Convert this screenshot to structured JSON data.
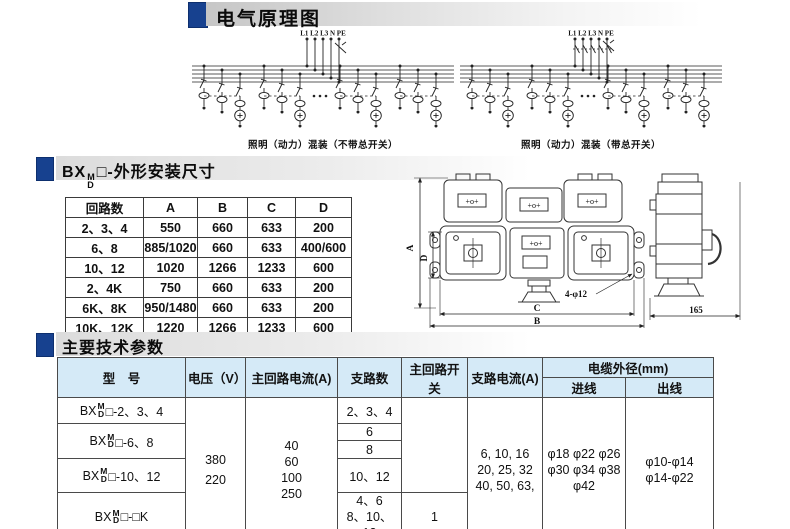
{
  "page": {
    "accent_blue": "#17418f",
    "spec_header_bg": "#d5eaf7"
  },
  "schematic_section": {
    "title": "电气原理图",
    "left_diagram": {
      "top_label": "L1 L2 L3 N PE",
      "caption": "照明（动力）混装（不带总开关）"
    },
    "right_diagram": {
      "top_label": "L1 L2 L3 N PE",
      "caption": "照明（动力）混装（带总开关）"
    }
  },
  "dimension_section": {
    "title_prefix": "BX",
    "title_sup": "M",
    "title_sub": "D",
    "title_suffix": "□-外形安装尺寸",
    "table": {
      "headers": [
        "回路数",
        "A",
        "B",
        "C",
        "D"
      ],
      "rows": [
        [
          "2、3、4",
          "550",
          "660",
          "633",
          "200"
        ],
        [
          "6、8",
          "885/1020",
          "660",
          "633",
          "400/600"
        ],
        [
          "10、12",
          "1020",
          "1266",
          "1233",
          "600"
        ],
        [
          "2、4K",
          "750",
          "660",
          "633",
          "200"
        ],
        [
          "6K、8K",
          "950/1480",
          "660",
          "633",
          "200"
        ],
        [
          "10K、12K",
          "1220",
          "1266",
          "1233",
          "600"
        ]
      ]
    },
    "drawing": {
      "dim_a": "A",
      "dim_d": "D",
      "dim_c": "C",
      "dim_b": "B",
      "holes_label": "4-φ12",
      "depth_label": "165",
      "terminal_mark": "+o+"
    }
  },
  "spec_section": {
    "title": "主要技术参数",
    "table": {
      "col_model": "型　号",
      "col_voltage": "电压（V）",
      "col_main_current": "主回路电流(A)",
      "col_branch_count": "支路数",
      "col_main_switch": "主回路开关",
      "col_branch_current": "支路电流(A)",
      "col_cable_od": "电缆外径(mm)",
      "col_inlet": "进线",
      "col_outlet": "出线",
      "models": [
        {
          "prefix": "BX",
          "sup": "M",
          "sub": "D",
          "suffix": "□-2、3、4"
        },
        {
          "prefix": "BX",
          "sup": "M",
          "sub": "D",
          "suffix": "□-6、8"
        },
        {
          "prefix": "BX",
          "sup": "M",
          "sub": "D",
          "suffix": "□-10、12"
        },
        {
          "prefix": "BX",
          "sup": "M",
          "sub": "D",
          "suffix": "□-□K"
        }
      ],
      "voltage": "380\n220",
      "main_current": "40\n60\n100\n250",
      "branch_counts": [
        "2、3、4",
        "6",
        "8",
        "10、12",
        "4、6\n8、10、12"
      ],
      "main_switch_value": "1",
      "branch_current": "6, 10, 16\n20, 25, 32\n40, 50, 63,",
      "inlet": "φ18 φ22 φ26\nφ30 φ34 φ38\nφ42",
      "outlet": "φ10-φ14\nφ14-φ22"
    }
  }
}
